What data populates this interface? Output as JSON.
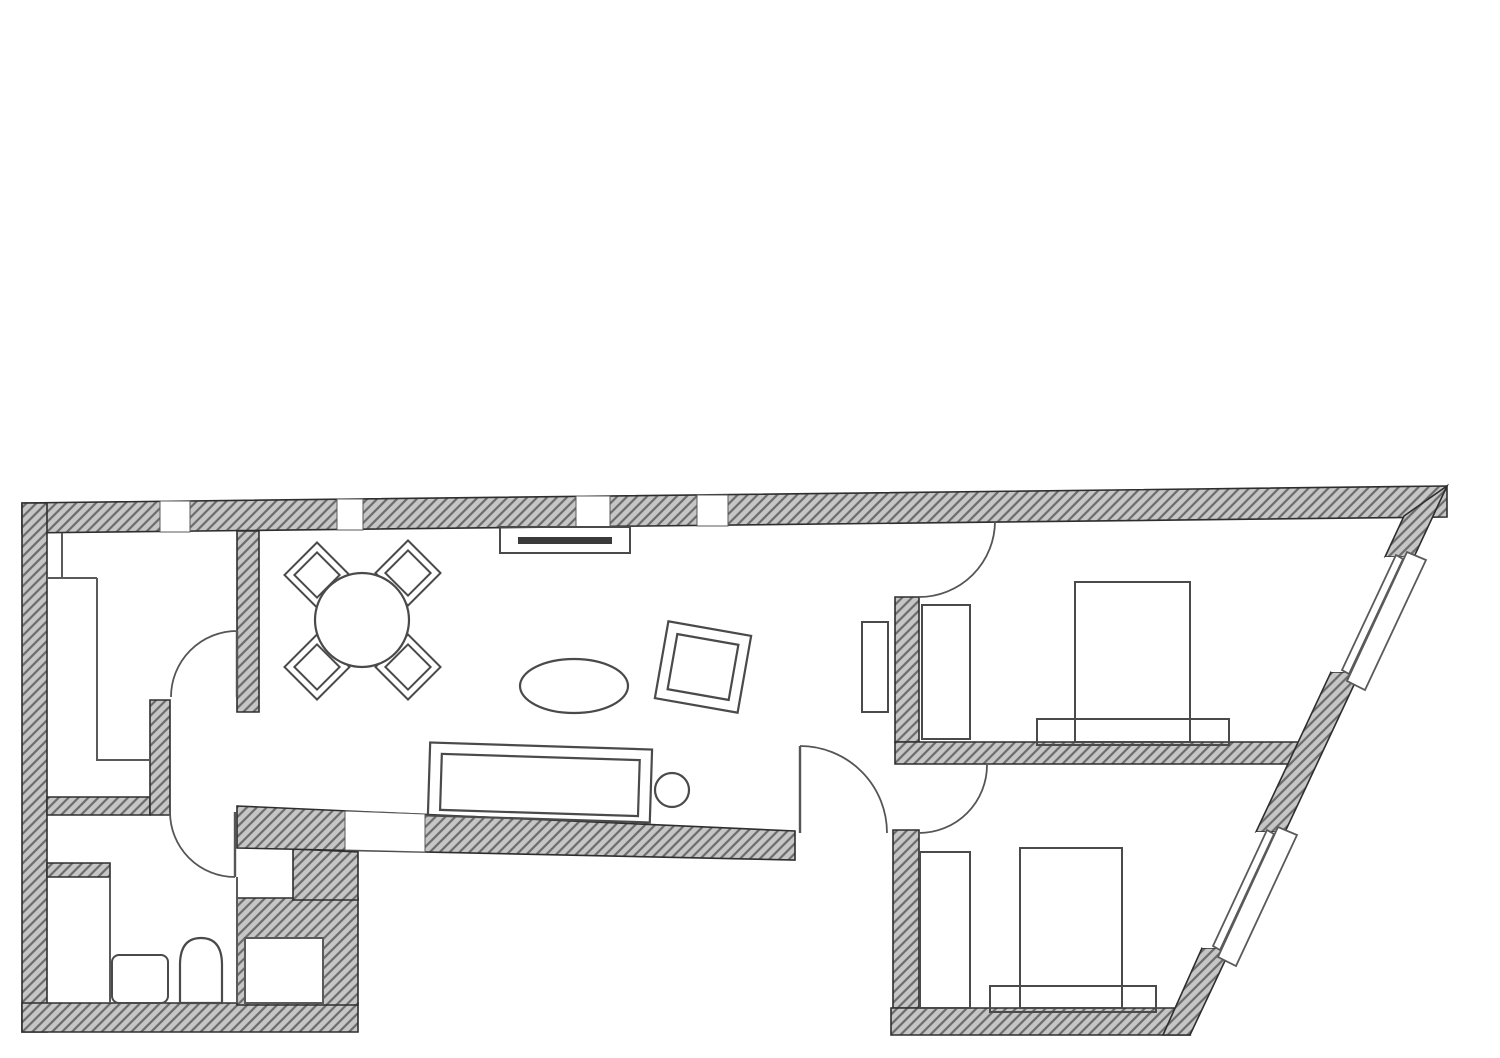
{
  "meta": {
    "canvas": {
      "width": 1500,
      "height": 1058,
      "background": "#ffffff"
    },
    "palette": {
      "wall_fill": "#c6c6c6",
      "wall_hatch": "#6b6b6b",
      "wall_edge": "#2e2e2e",
      "furniture_line": "#4a4a4a",
      "door_line": "#555555",
      "thin_line": "#5a5a5a",
      "white": "#ffffff"
    }
  },
  "floorplan": {
    "walls": [
      {
        "name": "top-wall",
        "points": [
          [
            22,
            503
          ],
          [
            1447,
            486
          ],
          [
            1447,
            517
          ],
          [
            22,
            533
          ]
        ]
      },
      {
        "name": "left-wall",
        "points": [
          [
            22,
            503
          ],
          [
            47,
            503
          ],
          [
            47,
            1032
          ],
          [
            22,
            1032
          ]
        ]
      },
      {
        "name": "bottom-left-wall",
        "points": [
          [
            22,
            1003
          ],
          [
            358,
            1003
          ],
          [
            358,
            1032
          ],
          [
            22,
            1032
          ]
        ]
      },
      {
        "name": "bath-right-mass",
        "points": [
          [
            237,
            898
          ],
          [
            358,
            898
          ],
          [
            358,
            1005
          ],
          [
            237,
            1005
          ]
        ]
      },
      {
        "name": "bath-step-mass",
        "points": [
          [
            293,
            849
          ],
          [
            358,
            852
          ],
          [
            358,
            900
          ],
          [
            293,
            900
          ]
        ]
      },
      {
        "name": "room-a-bottom-wall",
        "points": [
          [
            47,
            797
          ],
          [
            150,
            797
          ],
          [
            150,
            815
          ],
          [
            47,
            815
          ]
        ]
      },
      {
        "name": "room-a-hall-wall",
        "points": [
          [
            150,
            700
          ],
          [
            170,
            700
          ],
          [
            170,
            815
          ],
          [
            150,
            815
          ]
        ]
      },
      {
        "name": "bath-top-stub",
        "points": [
          [
            47,
            863
          ],
          [
            110,
            863
          ],
          [
            110,
            877
          ],
          [
            47,
            877
          ]
        ]
      },
      {
        "name": "room-a-right-wall",
        "points": [
          [
            237,
            531
          ],
          [
            259,
            531
          ],
          [
            259,
            712
          ],
          [
            237,
            712
          ]
        ]
      },
      {
        "name": "living-bottom-wall",
        "points": [
          [
            237,
            806
          ],
          [
            795,
            831
          ],
          [
            795,
            860
          ],
          [
            237,
            848
          ]
        ]
      },
      {
        "name": "bedroom-left-wall-upper",
        "points": [
          [
            895,
            597
          ],
          [
            919,
            597
          ],
          [
            919,
            742
          ],
          [
            895,
            742
          ]
        ]
      },
      {
        "name": "bedroom-divider-wall",
        "points": [
          [
            895,
            742
          ],
          [
            1299,
            742
          ],
          [
            1290,
            764
          ],
          [
            895,
            764
          ]
        ]
      },
      {
        "name": "bedroom-left-wall-lower",
        "points": [
          [
            893,
            830
          ],
          [
            919,
            830
          ],
          [
            919,
            1008
          ],
          [
            893,
            1008
          ]
        ]
      },
      {
        "name": "bedroom-bottom-wall",
        "points": [
          [
            891,
            1008
          ],
          [
            1174,
            1008
          ],
          [
            1190,
            1035
          ],
          [
            891,
            1035
          ]
        ]
      },
      {
        "name": "angled-wall-top",
        "points": [
          [
            1447,
            486
          ],
          [
            1414,
            557
          ],
          [
            1385,
            557
          ],
          [
            1404,
            516
          ]
        ]
      },
      {
        "name": "angled-wall-mid",
        "points": [
          [
            1360,
            672
          ],
          [
            1285,
            832
          ],
          [
            1256,
            832
          ],
          [
            1331,
            672
          ]
        ]
      },
      {
        "name": "angled-wall-bottom",
        "points": [
          [
            1231,
            948
          ],
          [
            1190,
            1035
          ],
          [
            1163,
            1035
          ],
          [
            1202,
            948
          ]
        ]
      }
    ],
    "openings": [
      {
        "name": "window-top-1",
        "points": [
          [
            160,
            501
          ],
          [
            190,
            501
          ],
          [
            190,
            532
          ],
          [
            160,
            532
          ]
        ]
      },
      {
        "name": "window-top-2",
        "points": [
          [
            337,
            499
          ],
          [
            363,
            499
          ],
          [
            363,
            530
          ],
          [
            337,
            530
          ]
        ]
      },
      {
        "name": "window-top-3",
        "points": [
          [
            576,
            496
          ],
          [
            610,
            496
          ],
          [
            610,
            527
          ],
          [
            576,
            527
          ]
        ]
      },
      {
        "name": "window-top-4",
        "points": [
          [
            697,
            495
          ],
          [
            728,
            495
          ],
          [
            728,
            526
          ],
          [
            697,
            526
          ]
        ]
      },
      {
        "name": "window-living-bottom",
        "points": [
          [
            345,
            811
          ],
          [
            425,
            814
          ],
          [
            425,
            852
          ],
          [
            345,
            850
          ]
        ]
      }
    ],
    "angled_windows": [
      {
        "name": "window-bedroom-upper",
        "gap": [
          [
            1414,
            557
          ],
          [
            1360,
            672
          ],
          [
            1331,
            672
          ],
          [
            1385,
            557
          ]
        ],
        "glass": [
          [
            1403,
            559
          ],
          [
            1349,
            674
          ],
          [
            1342,
            670
          ],
          [
            1396,
            555
          ]
        ],
        "sill": [
          [
            1407,
            552
          ],
          [
            1347,
            681
          ],
          [
            1365,
            690
          ],
          [
            1426,
            560
          ]
        ]
      },
      {
        "name": "window-bedroom-lower",
        "gap": [
          [
            1285,
            832
          ],
          [
            1231,
            948
          ],
          [
            1202,
            948
          ],
          [
            1256,
            832
          ]
        ],
        "glass": [
          [
            1274,
            834
          ],
          [
            1220,
            950
          ],
          [
            1213,
            946
          ],
          [
            1267,
            830
          ]
        ],
        "sill": [
          [
            1278,
            827
          ],
          [
            1218,
            957
          ],
          [
            1236,
            966
          ],
          [
            1297,
            835
          ]
        ]
      }
    ],
    "doors": [
      {
        "name": "door-room-a",
        "arc": "M 171 697 A 66 66 0 0 1 237 631",
        "leaf": [
          [
            237,
            631
          ],
          [
            237,
            697
          ]
        ]
      },
      {
        "name": "door-bathroom",
        "arc": "M 170 812 A 65 65 0 0 0 235 877",
        "leaf": [
          [
            235,
            812
          ],
          [
            235,
            877
          ]
        ]
      },
      {
        "name": "door-living-lobby",
        "arc": "M 800 746 A 87 87 0 0 1 887 833",
        "leaf": [
          [
            800,
            746
          ],
          [
            800,
            833
          ]
        ]
      },
      {
        "name": "door-bedroom-upper",
        "arc": "M 995 521 A 76 76 0 0 1 919 597",
        "leaf": null
      },
      {
        "name": "door-bedroom-lower",
        "arc": "M 919 833 A 68 68 0 0 0 987 765",
        "leaf": null
      }
    ],
    "furniture": [
      {
        "name": "dining-chair-nw",
        "type": "chair",
        "cx": 317,
        "cy": 575,
        "outer": 46,
        "inner": 32
      },
      {
        "name": "dining-chair-ne",
        "type": "chair",
        "cx": 408,
        "cy": 573,
        "outer": 46,
        "inner": 32
      },
      {
        "name": "dining-chair-sw",
        "type": "chair",
        "cx": 317,
        "cy": 667,
        "outer": 46,
        "inner": 32
      },
      {
        "name": "dining-chair-se",
        "type": "chair",
        "cx": 408,
        "cy": 667,
        "outer": 46,
        "inner": 32
      },
      {
        "name": "dining-table",
        "type": "circle",
        "cx": 362,
        "cy": 620,
        "r": 47,
        "fill": "white"
      },
      {
        "name": "sideboard",
        "type": "rect",
        "x": 500,
        "y": 527,
        "w": 130,
        "h": 26
      },
      {
        "name": "sideboard-shelf",
        "type": "bar",
        "x": 518,
        "y": 537,
        "w": 94,
        "h": 7
      },
      {
        "name": "rug",
        "type": "ellipse",
        "cx": 574,
        "cy": 686,
        "rx": 54,
        "ry": 27
      },
      {
        "name": "armchair",
        "type": "nested",
        "outer": [
          661,
          628,
          84,
          78
        ],
        "inner": [
          672,
          639,
          62,
          56
        ],
        "rot": 10,
        "ox": 703,
        "oy": 667
      },
      {
        "name": "sofa",
        "type": "nested",
        "outer": [
          429,
          746,
          222,
          73
        ],
        "inner": [
          441,
          757,
          198,
          56
        ],
        "rot": 1.8,
        "ox": 540,
        "oy": 782
      },
      {
        "name": "side-table",
        "type": "circle",
        "cx": 672,
        "cy": 790,
        "r": 17
      },
      {
        "name": "living-shelf",
        "type": "rect",
        "x": 862,
        "y": 622,
        "w": 26,
        "h": 90
      },
      {
        "name": "wardrobe-bedroom-upper",
        "type": "rect",
        "x": 922,
        "y": 605,
        "w": 48,
        "h": 134
      },
      {
        "name": "bed-upper",
        "type": "rect",
        "x": 1075,
        "y": 582,
        "w": 115,
        "h": 160
      },
      {
        "name": "bed-bench-upper",
        "type": "rect",
        "x": 1037,
        "y": 719,
        "w": 192,
        "h": 26
      },
      {
        "name": "wardrobe-bedroom-lower",
        "type": "rect",
        "x": 920,
        "y": 852,
        "w": 50,
        "h": 156
      },
      {
        "name": "bed-lower",
        "type": "rect",
        "x": 1020,
        "y": 848,
        "w": 102,
        "h": 160
      },
      {
        "name": "bed-bench-lower",
        "type": "rect",
        "x": 990,
        "y": 986,
        "w": 166,
        "h": 26
      },
      {
        "name": "bath-sink",
        "type": "rect",
        "x": 112,
        "y": 955,
        "w": 56,
        "h": 48,
        "rx": 7
      },
      {
        "name": "bath-toilet",
        "type": "path",
        "d": "M 180 1003 L 180 965 Q 180 938 201 938 Q 222 938 222 965 L 222 1003 Z"
      },
      {
        "name": "wall-niche",
        "type": "rect",
        "x": 245,
        "y": 938,
        "w": 78,
        "h": 65,
        "fill": "white"
      }
    ],
    "lines": [
      {
        "name": "closet-room-a-top",
        "points": [
          [
            47,
            578
          ],
          [
            97,
            578
          ]
        ]
      },
      {
        "name": "closet-room-a-divider",
        "points": [
          [
            62,
            533
          ],
          [
            62,
            578
          ]
        ]
      },
      {
        "name": "wardrobe-room-a-outline",
        "points": [
          [
            97,
            578
          ],
          [
            97,
            760
          ],
          [
            150,
            760
          ]
        ]
      },
      {
        "name": "bath-partition",
        "points": [
          [
            110,
            877
          ],
          [
            110,
            1003
          ]
        ]
      },
      {
        "name": "bath-niche-edge",
        "points": [
          [
            237,
            877
          ],
          [
            237,
            1003
          ]
        ]
      }
    ]
  }
}
